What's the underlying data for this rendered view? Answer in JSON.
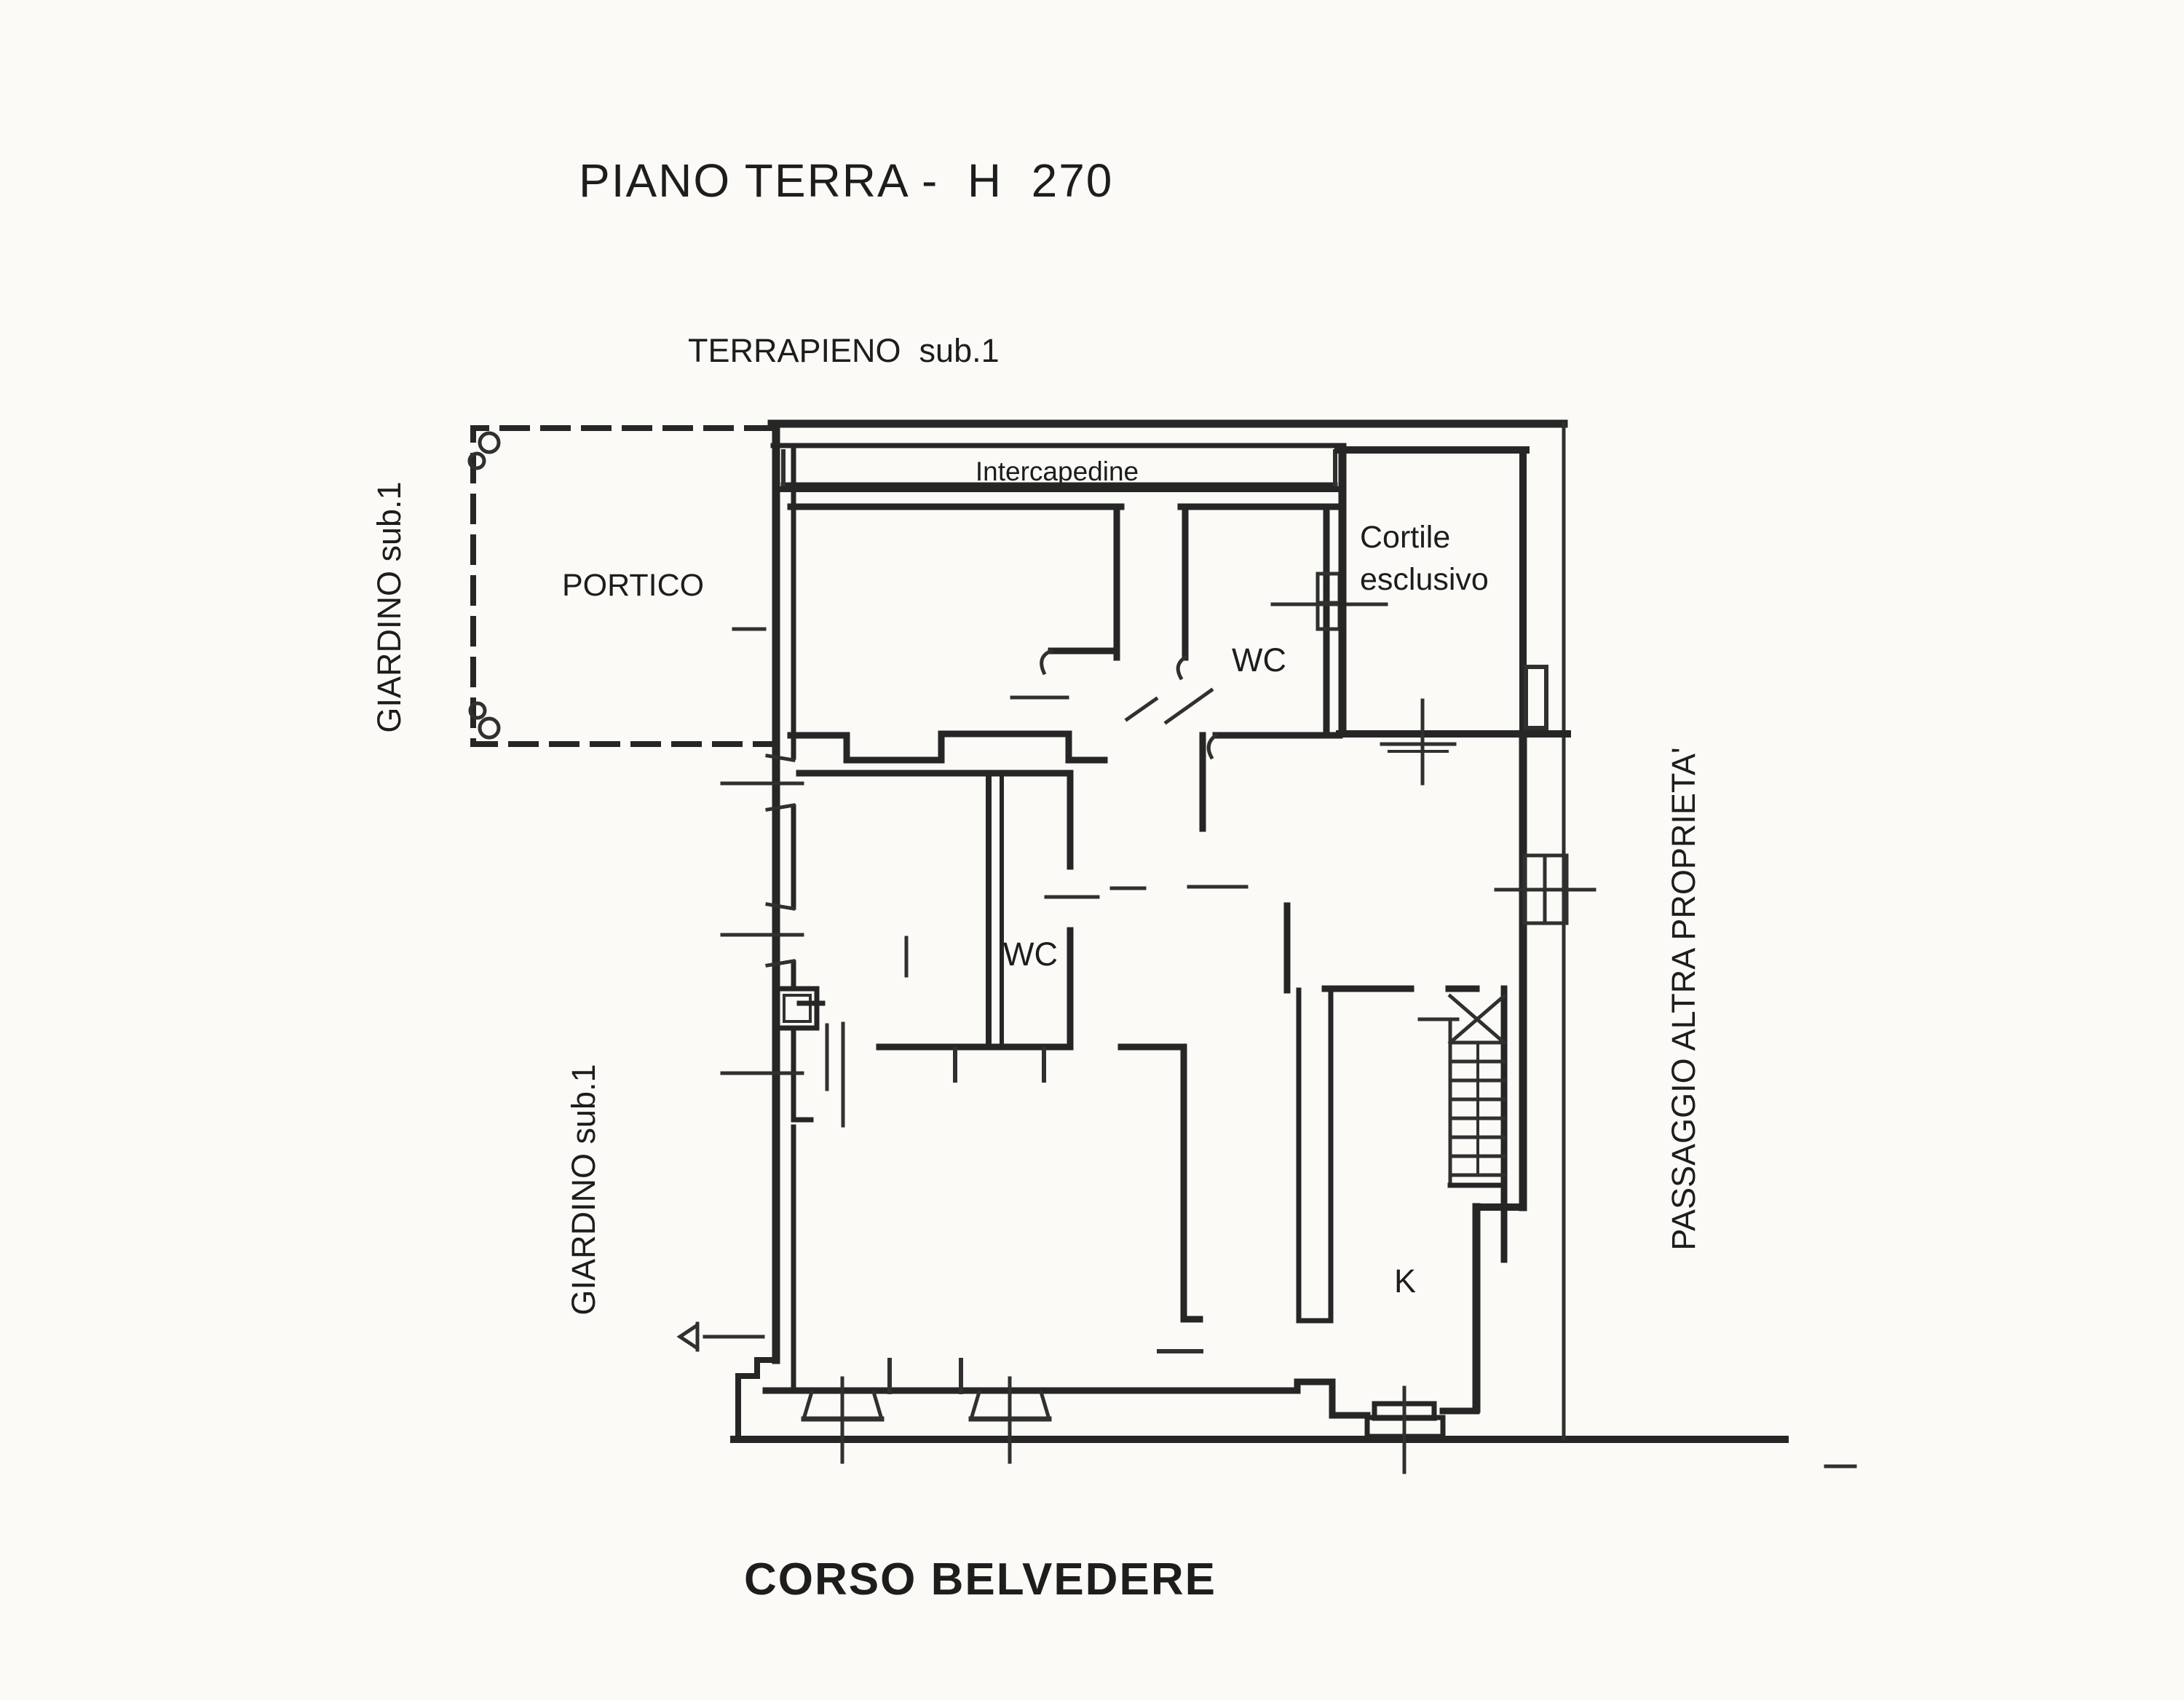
{
  "colors": {
    "paper": "#fbfaf6",
    "ink": "#262626",
    "text": "#1d1d1d"
  },
  "plan": {
    "title": "PIANO TERRA -  H  270",
    "labels": {
      "terrapieno": "TERRAPIENO  sub.1",
      "giardino_top": "GIARDINO sub.1",
      "giardino_bottom": "GIARDINO sub.1",
      "portico": "PORTICO",
      "intercapedine": "Intercapedine",
      "cortile_line1": "Cortile",
      "cortile_line2": "esclusivo",
      "wc_top": "WC",
      "wc_middle": "WC",
      "kitchen": "K",
      "passaggio": "PASSAGGIO ALTRA PROPRIETA'",
      "street": "CORSO BELVEDERE"
    }
  }
}
